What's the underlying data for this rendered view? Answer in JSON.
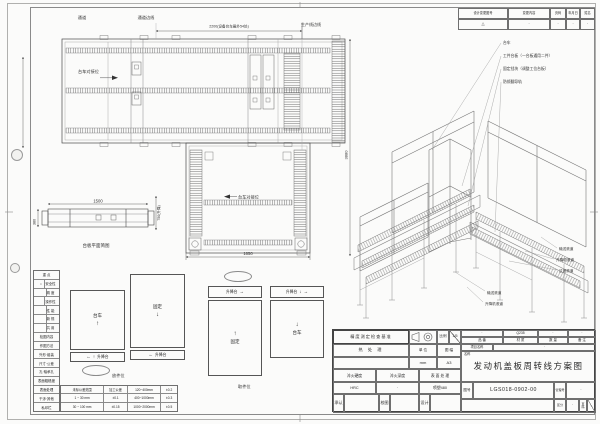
{
  "revision": {
    "headers": [
      "设计变更图号",
      "变更内容",
      "页码",
      "年月日",
      "姓名"
    ],
    "row": [
      "△",
      "·",
      "·",
      "·",
      "·"
    ]
  },
  "plan": {
    "aisle": "通道",
    "aisle_edge": "通道边线",
    "dim_top": "2200(设备台车最外54处)",
    "prod_edge": "生产线边线",
    "dock1": "台车对接位",
    "dock2": "台车对接位",
    "dim_total": "3880",
    "dim_bottom": "1650",
    "pf_width": "1500",
    "pf_depth": "380",
    "pf_lift": "750(升降)",
    "pf_caption": "台板平面简图"
  },
  "iso": {
    "top_labels": [
      "台车",
      "工件台板（一台板通用二件）",
      "固定挡块（调整工位台板）",
      "防倾翻导轨"
    ],
    "right_labels": [
      "输送滚道",
      "升降机滚道",
      "过渡滚道"
    ],
    "left_labels": [
      "输送滚道",
      "升降机滚道"
    ]
  },
  "checklist": {
    "mark": "○",
    "rows": [
      "重  点",
      "安全性",
      "精  度",
      "操作性",
      "性  能",
      "新  规",
      "共  用",
      "检图内容",
      "作图方法",
      "外形·组装",
      "尺寸·公差",
      "孔·轴承孔",
      "表面粗糙度",
      "表面处理",
      "干涉·其他",
      "私印栏"
    ]
  },
  "tolerance": {
    "rows": [
      [
        "未标公差范围",
        "加工公差",
        "120~400mm",
        "±0.2"
      ],
      [
        "1 ~ 30 mm",
        "±0.1",
        "400~1000mm",
        "±0.3"
      ],
      [
        "30 ~ 100 mm",
        "±0.15",
        "1000~2000mm",
        "±0.5"
      ]
    ]
  },
  "details": {
    "cart": "台车",
    "fixed": "固定",
    "lift": "升降台",
    "load_caption": "放件位",
    "unload_caption": "取件位",
    "arrow_up": "↑",
    "arrow_down": "↓",
    "arrow_left": "←",
    "arrow_right": "→"
  },
  "titleblock": {
    "check_title": "精度测定检查基准",
    "scale_label": "比例",
    "scale_value": "1/5",
    "heat_label": "热 处 理",
    "unit_label": "单 位",
    "unit_value": "mm",
    "format_label": "图 幅",
    "format_value": "A3",
    "partno_label": "品 番",
    "material_label": "材 质",
    "qty_label": "数 量",
    "remark_label": "备 注",
    "partno_value": "·",
    "material_value": "Q235",
    "qty_value": "·",
    "remark_value": "·",
    "project_label": "项目名称",
    "project_value": "·",
    "name_label": "名称",
    "name_value": "发动机盖板周转线方案图",
    "hardness_label": "淬火硬度",
    "hardness_value": "HRC",
    "depth_label": "淬火深度",
    "depth_value": "·",
    "surface_label": "表 面 处 理",
    "surface_value": "喷塑480",
    "approve_label": "承认",
    "check_label": "校图",
    "design_label": "设计",
    "dwgno_label": "图号",
    "dwgno_value": "LGS018-0902-00",
    "mgmt_label": "管理号",
    "mgmt_value": "·",
    "class_label": "区分",
    "class_value": "·",
    "page_label": "页码"
  }
}
